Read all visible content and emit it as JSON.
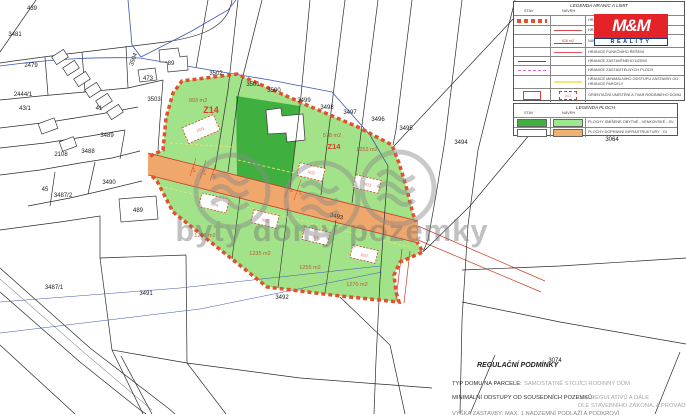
{
  "map": {
    "watermark": "byty domy pozemky",
    "road_fill": "#f0a76b",
    "zone_green_light": "#a2e289",
    "zone_green_dark": "#3fb040",
    "boundary_dash_color": "#e2512e",
    "parcel_numbers": [
      {
        "t": "439",
        "x": 32,
        "y": 10
      },
      {
        "t": "3481",
        "x": 15,
        "y": 36
      },
      {
        "t": "2479",
        "x": 31,
        "y": 67
      },
      {
        "t": "2444/1",
        "x": 23,
        "y": 96
      },
      {
        "t": "43/1",
        "x": 25,
        "y": 110
      },
      {
        "t": "41",
        "x": 99,
        "y": 110
      },
      {
        "t": "2108",
        "x": 61,
        "y": 156
      },
      {
        "t": "3488",
        "x": 88,
        "y": 153
      },
      {
        "t": "3489",
        "x": 107,
        "y": 137
      },
      {
        "t": "3490",
        "x": 109,
        "y": 184
      },
      {
        "t": "45",
        "x": 45,
        "y": 191
      },
      {
        "t": "3487/2",
        "x": 63,
        "y": 197
      },
      {
        "t": "489",
        "x": 138,
        "y": 212
      },
      {
        "t": "3487/1",
        "x": 54,
        "y": 289
      },
      {
        "t": "3491",
        "x": 146,
        "y": 295
      },
      {
        "t": "3492",
        "x": 282,
        "y": 299
      },
      {
        "t": "3502",
        "x": 216,
        "y": 75
      },
      {
        "t": "3501",
        "x": 253,
        "y": 86
      },
      {
        "t": "3500",
        "x": 274,
        "y": 92
      },
      {
        "t": "3499",
        "x": 304,
        "y": 102
      },
      {
        "t": "3498",
        "x": 327,
        "y": 109
      },
      {
        "t": "3497",
        "x": 350,
        "y": 114
      },
      {
        "t": "3496",
        "x": 378,
        "y": 121
      },
      {
        "t": "3495",
        "x": 406,
        "y": 130
      },
      {
        "t": "3494",
        "x": 461,
        "y": 144
      },
      {
        "t": "3503",
        "x": 154,
        "y": 101
      },
      {
        "t": "3504",
        "x": 135,
        "y": 60,
        "r": -70
      },
      {
        "t": "89",
        "x": 171,
        "y": 65
      },
      {
        "t": "473",
        "x": 148,
        "y": 80
      },
      {
        "t": "3064",
        "x": 612,
        "y": 141
      },
      {
        "t": "3074",
        "x": 555,
        "y": 362
      },
      {
        "t": "3493",
        "x": 336,
        "y": 218,
        "r": 13
      }
    ],
    "zone_labels": [
      {
        "t": "Z14",
        "x": 211,
        "y": 113,
        "s": 9
      },
      {
        "t": "Z14",
        "x": 334,
        "y": 149,
        "s": 7.5
      }
    ],
    "area_labels": [
      {
        "t": "993 m2",
        "x": 198,
        "y": 102
      },
      {
        "t": "578 m2",
        "x": 332,
        "y": 137
      },
      {
        "t": "1253 m2",
        "x": 367,
        "y": 151
      },
      {
        "t": "1245 m2",
        "x": 205,
        "y": 237
      },
      {
        "t": "1235 m2",
        "x": 260,
        "y": 255
      },
      {
        "t": "1255 m2",
        "x": 310,
        "y": 269
      },
      {
        "t": "1270 m2",
        "x": 357,
        "y": 286
      }
    ],
    "house_labels": [
      {
        "t": "X01",
        "x": 201,
        "y": 131,
        "r": -23
      },
      {
        "t": "X02",
        "x": 311,
        "y": 174,
        "r": 13
      },
      {
        "t": "X03",
        "x": 367,
        "y": 186,
        "r": 13
      },
      {
        "t": "X04",
        "x": 214,
        "y": 206,
        "r": 13
      },
      {
        "t": "X05",
        "x": 265,
        "y": 222,
        "r": 13
      },
      {
        "t": "X06",
        "x": 316,
        "y": 239,
        "r": 13
      },
      {
        "t": "X07",
        "x": 364,
        "y": 257,
        "r": 13
      }
    ],
    "dimension_labels": [
      {
        "t": "4.0",
        "x": 193,
        "y": 170,
        "r": 77
      },
      {
        "t": "4.0",
        "x": 203,
        "y": 173,
        "r": 77
      },
      {
        "t": "3.5",
        "x": 213,
        "y": 176,
        "r": 77
      },
      {
        "t": "4.0",
        "x": 290,
        "y": 190,
        "r": 77
      },
      {
        "t": "3.5",
        "x": 299,
        "y": 193,
        "r": 77
      }
    ]
  },
  "legend_limits": {
    "title": "LEGENDA HRANIC A LIMIT",
    "col1": "STAV",
    "col2": "NÁVRH",
    "area_sample": "626 m2",
    "house_sample": "X01",
    "rows": [
      "HRANICE ŘEŠENÉHO ÚZEMÍ",
      "HRANICE PARCEL",
      "NAVRŽENÉ HRANICE A VÝMĚRY POZEMKŮ",
      "HRANICE FUNKČNÍHO ŘEŠENÍ",
      "HRANICE ZASTAVĚNÉHO ÚZEMÍ",
      "HRANICE ZASTAVITELNÝCH PLOCH",
      "HRANICE MINIMÁLNÍHO ODSTUPU ZÁSTAVBY OD HRANICE PARCELY",
      "ORIENTAČNÍ UMÍSTĚNÍ A TVAR RODINNÉHO DOMU"
    ]
  },
  "legend_ploch": {
    "title": "LEGENDA PLOCH",
    "col1": "STAV",
    "col2": "NÁVRH",
    "rows": [
      "PLOCHY SMÍŠENÉ OBYTNÉ - VENKOVSKÉ - SV",
      "PLOCHY DOPRAVNÍ INFRASTRUKTURY - DI"
    ]
  },
  "logo": {
    "top": "M&M",
    "bottom": "REALITY"
  },
  "regulations": {
    "title": "REGULAČNÍ PODMÍNKY",
    "row1_label": "TYP DOMU NA PARCELE:",
    "row1_value": "SAMOSTATNĚ STOJÍCÍ RODINNÝ DŮM",
    "row2_label": "MINIMÁLNÍ ODSTUPY OD SOUSEDNÍCH POZEMKŮ:",
    "row2_value1": "DLE REGULATIVŮ A DÁLE",
    "row2_value2": "DLE STAVEBNÍHO ZÁKONA, A PROVÁDĚCÍCH VYHLÁŠEK",
    "row3_text": "VÝŠKA ZÁSTAVBY: MAX. 1 NADZEMNÍ PODLAŽÍ A PODKROVÍ"
  }
}
